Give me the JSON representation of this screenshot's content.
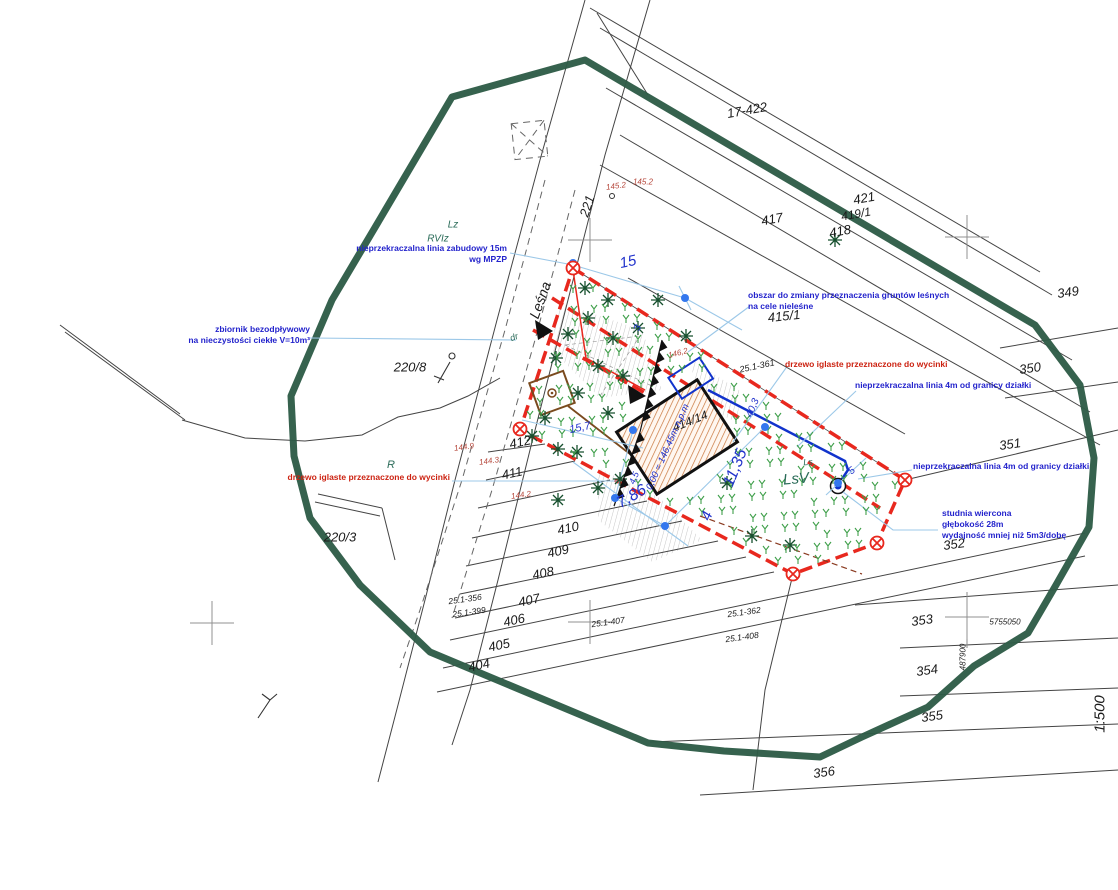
{
  "annotations": {
    "zabudowy": {
      "l1": "nieprzekraczalna linia zabudowy 15m",
      "l2": "wg MPZP"
    },
    "zbiornik": {
      "l1": "zbiornik bezodpływowy",
      "l2": "na nieczystości ciekłe V=10m³"
    },
    "obszar": {
      "l1": "obszar do zmiany przeznaczenia gruntów leśnych",
      "l2": "na cele nieleśne"
    },
    "drzewo_right": {
      "l1": "drzewo iglaste przeznaczone do wycinki"
    },
    "linia4m_1": {
      "l1": "nieprzekraczalna linia 4m od granicy działki"
    },
    "linia4m_2": {
      "l1": "nieprzekraczalna linia 4m od granicy działki"
    },
    "studnia": {
      "l1": "studnia wiercona",
      "l2": "głębokość 28m",
      "l3": "wydajność mniej niż 5m3/dobę"
    },
    "drzewo_left": {
      "l1": "drzewo iglaste przeznaczone do wycinki"
    }
  },
  "labels": {
    "parcels": [
      {
        "t": "17-422",
        "x": 747,
        "y": 110,
        "r": -10,
        "s": 13
      },
      {
        "t": "421",
        "x": 864,
        "y": 198,
        "r": -10,
        "s": 13
      },
      {
        "t": "419/1",
        "x": 856,
        "y": 214,
        "r": -10,
        "s": 12
      },
      {
        "t": "417",
        "x": 772,
        "y": 219,
        "r": -10,
        "s": 13
      },
      {
        "t": "418",
        "x": 840,
        "y": 231,
        "r": -10,
        "s": 13
      },
      {
        "t": "349",
        "x": 1068,
        "y": 292,
        "r": -8,
        "s": 13
      },
      {
        "t": "350",
        "x": 1030,
        "y": 368,
        "r": -8,
        "s": 13
      },
      {
        "t": "351",
        "x": 1010,
        "y": 444,
        "r": -8,
        "s": 13
      },
      {
        "t": "352",
        "x": 954,
        "y": 544,
        "r": -8,
        "s": 13
      },
      {
        "t": "353",
        "x": 922,
        "y": 620,
        "r": -8,
        "s": 13
      },
      {
        "t": "354",
        "x": 927,
        "y": 670,
        "r": -8,
        "s": 13
      },
      {
        "t": "355",
        "x": 932,
        "y": 716,
        "r": -8,
        "s": 13
      },
      {
        "t": "356",
        "x": 824,
        "y": 772,
        "r": -8,
        "s": 13
      },
      {
        "t": "415/1",
        "x": 784,
        "y": 316,
        "r": -6,
        "s": 13
      },
      {
        "t": "414/14",
        "x": 690,
        "y": 421,
        "r": -22,
        "s": 12
      },
      {
        "t": "412",
        "x": 520,
        "y": 442,
        "r": -12,
        "s": 13
      },
      {
        "t": "411",
        "x": 512,
        "y": 473,
        "r": -12,
        "s": 13
      },
      {
        "t": "410",
        "x": 568,
        "y": 528,
        "r": -12,
        "s": 13
      },
      {
        "t": "409",
        "x": 558,
        "y": 551,
        "r": -12,
        "s": 13
      },
      {
        "t": "408",
        "x": 543,
        "y": 573,
        "r": -12,
        "s": 13
      },
      {
        "t": "407",
        "x": 529,
        "y": 600,
        "r": -12,
        "s": 13
      },
      {
        "t": "406",
        "x": 514,
        "y": 620,
        "r": -12,
        "s": 13
      },
      {
        "t": "405",
        "x": 499,
        "y": 645,
        "r": -12,
        "s": 13
      },
      {
        "t": "404",
        "x": 479,
        "y": 665,
        "r": -12,
        "s": 13
      },
      {
        "t": "220/8",
        "x": 410,
        "y": 367,
        "r": 0,
        "s": 13
      },
      {
        "t": "220/3",
        "x": 340,
        "y": 537,
        "r": 0,
        "s": 13
      },
      {
        "t": "221",
        "x": 587,
        "y": 206,
        "r": -72,
        "s": 13
      },
      {
        "t": "Leśna",
        "x": 540,
        "y": 300,
        "r": -70,
        "s": 14
      },
      {
        "t": "25.1-361",
        "x": 757,
        "y": 366,
        "r": -12,
        "s": 9
      },
      {
        "t": "25.1-356",
        "x": 465,
        "y": 599,
        "r": -8,
        "s": 8.5
      },
      {
        "t": "25.1-399",
        "x": 469,
        "y": 612,
        "r": -8,
        "s": 8.5
      },
      {
        "t": "25.1-407",
        "x": 608,
        "y": 622,
        "r": -8,
        "s": 8.5
      },
      {
        "t": "25.1-362",
        "x": 744,
        "y": 612,
        "r": -8,
        "s": 8.5
      },
      {
        "t": "25.1-408",
        "x": 742,
        "y": 637,
        "r": -8,
        "s": 8.5
      },
      {
        "t": "5755050",
        "x": 1005,
        "y": 622,
        "r": 0,
        "s": 8
      },
      {
        "t": "487900",
        "x": 963,
        "y": 657,
        "r": -90,
        "s": 8
      },
      {
        "t": "1:500",
        "x": 1100,
        "y": 714,
        "r": -90,
        "s": 15
      }
    ],
    "landuse": [
      {
        "t": "Lz",
        "x": 453,
        "y": 225,
        "r": 0,
        "s": 10
      },
      {
        "t": "RVIz",
        "x": 438,
        "y": 239,
        "r": 0,
        "s": 10
      },
      {
        "t": "R",
        "x": 391,
        "y": 465,
        "r": 0,
        "s": 11
      },
      {
        "t": "dr",
        "x": 514,
        "y": 337,
        "r": -20,
        "s": 9
      },
      {
        "t": "LsV",
        "x": 796,
        "y": 479,
        "r": -5,
        "s": 15
      },
      {
        "t": "Ls",
        "x": 808,
        "y": 462,
        "r": -5,
        "s": 9
      }
    ],
    "spot_heights": [
      {
        "t": "145.2",
        "x": 616,
        "y": 186,
        "r": -8,
        "s": 8
      },
      {
        "t": "145.2",
        "x": 643,
        "y": 182,
        "r": 0,
        "s": 8
      },
      {
        "t": "146,2",
        "x": 678,
        "y": 353,
        "r": -15,
        "s": 8
      },
      {
        "t": "144.9",
        "x": 464,
        "y": 447,
        "r": -8,
        "s": 8
      },
      {
        "t": "144.3",
        "x": 489,
        "y": 461,
        "r": -8,
        "s": 8
      },
      {
        "t": "144.2",
        "x": 521,
        "y": 495,
        "r": -8,
        "s": 8
      }
    ],
    "dimensions": [
      {
        "t": "15",
        "x": 628,
        "y": 262,
        "r": -12,
        "s": 15
      },
      {
        "t": "15,7",
        "x": 580,
        "y": 428,
        "r": -12,
        "s": 11
      },
      {
        "t": "7,86",
        "x": 632,
        "y": 497,
        "r": -30,
        "s": 16
      },
      {
        "t": "11,35",
        "x": 736,
        "y": 468,
        "r": -68,
        "s": 16
      },
      {
        "t": "4",
        "x": 707,
        "y": 516,
        "r": -68,
        "s": 15
      },
      {
        "t": "40,3",
        "x": 753,
        "y": 408,
        "r": -68,
        "s": 10
      },
      {
        "t": "3",
        "x": 638,
        "y": 328,
        "r": -68,
        "s": 10
      },
      {
        "t": "4,5",
        "x": 634,
        "y": 478,
        "r": -68,
        "s": 9
      },
      {
        "t": "5",
        "x": 852,
        "y": 471,
        "r": -40,
        "s": 10
      },
      {
        "t": "0,00 = 146,45m n.p.m",
        "x": 668,
        "y": 447,
        "r": -66,
        "s": 9.5
      }
    ]
  },
  "map_points": {
    "survey_crosses": [
      [
        590,
        240
      ],
      [
        967,
        237
      ],
      [
        212,
        623
      ],
      [
        590,
        622
      ],
      [
        967,
        617
      ]
    ],
    "boundary_markers": [
      [
        573,
        268
      ],
      [
        520,
        429
      ],
      [
        905,
        480
      ],
      [
        877,
        543
      ],
      [
        793,
        574
      ]
    ],
    "blue_dots": [
      [
        573,
        263
      ],
      [
        685,
        298
      ],
      [
        765,
        427
      ],
      [
        838,
        483
      ],
      [
        615,
        498
      ],
      [
        665,
        526
      ],
      [
        633,
        430
      ]
    ],
    "conifers": [
      [
        585,
        288
      ],
      [
        608,
        300
      ],
      [
        588,
        318
      ],
      [
        568,
        334
      ],
      [
        613,
        338
      ],
      [
        638,
        328
      ],
      [
        658,
        300
      ],
      [
        686,
        336
      ],
      [
        556,
        358
      ],
      [
        598,
        366
      ],
      [
        623,
        376
      ],
      [
        578,
        393
      ],
      [
        545,
        418
      ],
      [
        608,
        413
      ],
      [
        532,
        436
      ],
      [
        558,
        449
      ],
      [
        577,
        452
      ],
      [
        598,
        488
      ],
      [
        620,
        479
      ],
      [
        558,
        500
      ],
      [
        727,
        483
      ],
      [
        752,
        536
      ],
      [
        790,
        545
      ],
      [
        835,
        240
      ]
    ],
    "arrows": [
      [
        535,
        320,
        553,
        331,
        538,
        340
      ],
      [
        628,
        385,
        646,
        396,
        630,
        404
      ]
    ],
    "teeth_line": [
      [
        662,
        340
      ],
      [
        640,
        432
      ],
      [
        614,
        506
      ]
    ],
    "grass_region": {
      "poly": [
        [
          578,
          274
        ],
        [
          898,
          482
        ],
        [
          872,
          540
        ],
        [
          793,
          570
        ],
        [
          524,
          428
        ]
      ],
      "step": 16
    },
    "well": {
      "x": 838,
      "y": 486
    }
  },
  "colors": {
    "green_edge": "#2e5c47",
    "red_boundary": "#e8281e",
    "blue_line": "#1133cc",
    "leader": "#9cc8e8",
    "annotation_blue": "#2323cc",
    "annotation_red": "#cc2211",
    "spot_height": "#b5463a",
    "building_hatch": "#c8763c",
    "conifer": "#17502e",
    "grass": "#3f9f4a"
  }
}
